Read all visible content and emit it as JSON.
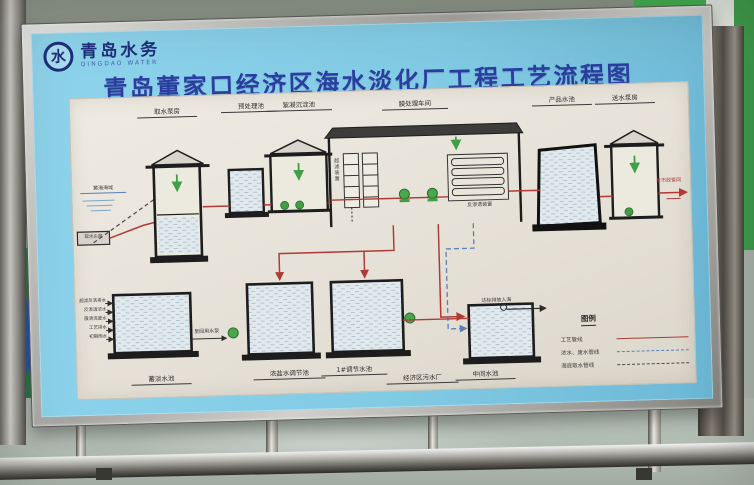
{
  "scene": {
    "logo_text": "青岛水务",
    "logo_sub": "QINGDAO WATER",
    "title": "青岛董家口经济区海水淡化厂工程工艺流程图"
  },
  "diagram": {
    "top_stations": [
      "取水泵房",
      "预处理池",
      "絮凝沉淀池",
      "膜处理车间",
      "产品水池",
      "送水泵房"
    ],
    "bottom_stations": [
      "蓄淡水池",
      "浓盐水调节池",
      "1#调节水池",
      "经济区污水厂",
      "中间水池"
    ],
    "inlet_labels": [
      "超滤反洗排水",
      "反渗透浓水",
      "膜清洗废水",
      "工艺排水",
      "初期雨水"
    ],
    "annotations": {
      "sea": "黄海海域",
      "intake_head": "取水头部",
      "uf_unit": "超滤装置",
      "ro_unit": "反渗透装置",
      "reuse": "至回用水泵",
      "outfall": "达标排放入海",
      "to_network": "至市政管网"
    },
    "legend": {
      "title": "图例",
      "items": [
        {
          "label": "工艺管线"
        },
        {
          "label": "浓水、废水管线"
        },
        {
          "label": "海底取水管线"
        }
      ]
    },
    "colors": {
      "process_line": "#b03a36",
      "waste_line": "#5b7fb9",
      "intake_line": "#4a4a4a",
      "pump": "#3f9e46",
      "board_blue": "#82cbe5",
      "title_blue": "#2b3e9f"
    }
  }
}
